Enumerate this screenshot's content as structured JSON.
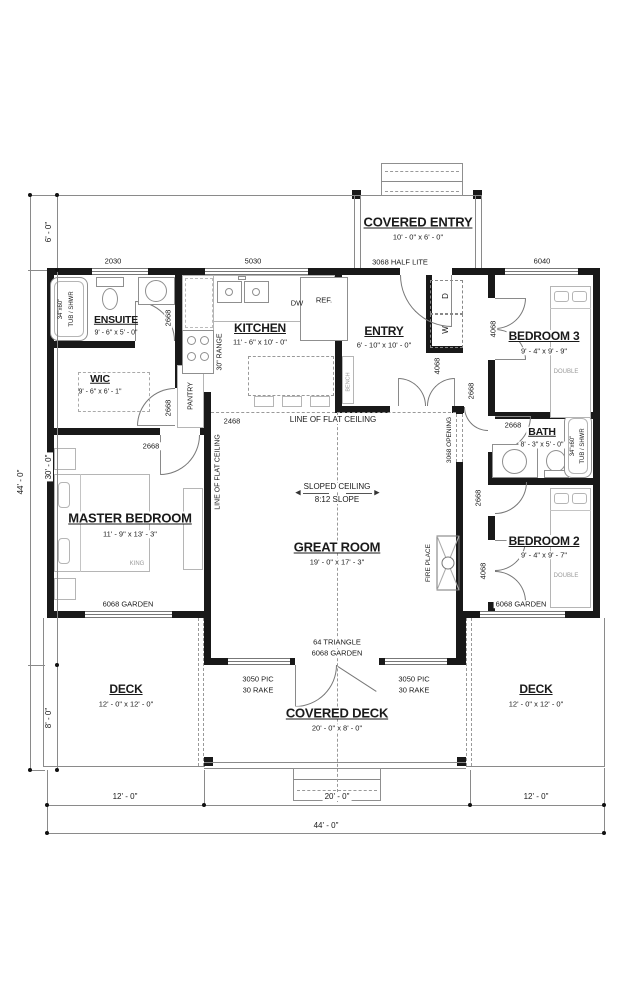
{
  "title": "Floor Plan",
  "rooms": {
    "covered_entry": {
      "name": "COVERED ENTRY",
      "dims": "10' - 0\" x 6' - 0\""
    },
    "ensuite": {
      "name": "ENSUITE",
      "dims": "9' - 6\" x 5' - 0\""
    },
    "wic": {
      "name": "WIC",
      "dims": "9' - 6\" x 6' - 1\""
    },
    "kitchen": {
      "name": "KITCHEN",
      "dims": "11' - 6\" x 10' - 0\""
    },
    "entry": {
      "name": "ENTRY",
      "dims": "6' - 10\" x 10' - 0\""
    },
    "bedroom3": {
      "name": "BEDROOM 3",
      "dims": "9' - 4\" x 9' - 9\""
    },
    "bath": {
      "name": "BATH",
      "dims": "8' - 3\" x 5' - 0\""
    },
    "master": {
      "name": "MASTER BEDROOM",
      "dims": "11' - 9\" x 13' - 3\""
    },
    "great": {
      "name": "GREAT ROOM",
      "dims": "19' - 0\" x 17' - 3\""
    },
    "bedroom2": {
      "name": "BEDROOM 2",
      "dims": "9' - 4\" x 9' - 7\""
    },
    "deck_left": {
      "name": "DECK",
      "dims": "12' - 0\" x 12' - 0\""
    },
    "covered_deck": {
      "name": "COVERED DECK",
      "dims": "20' - 0\" x 8' - 0\""
    },
    "deck_right": {
      "name": "DECK",
      "dims": "12' - 0\" x 12' - 0\""
    }
  },
  "openings": {
    "w2030": "2030",
    "w5030": "5030",
    "w6040": "6040",
    "half_lite": "3068 HALF LITE",
    "opening_3068": "3068 OPENING",
    "d2668": "2668",
    "d2468": "2468",
    "d4068": "4068",
    "garden_6068": "6068 GARDEN",
    "triangle_64": "64 TRIANGLE",
    "pic_3050": "3050 PIC",
    "rake_30": "30 RAKE"
  },
  "annotations": {
    "flat_ceiling": "LINE OF FLAT CEILING",
    "sloped_ceiling": "SLOPED CEILING",
    "slope": "8:12 SLOPE",
    "arrow_left": "◀",
    "arrow_right": "▶",
    "fireplace": "FIRE PLACE",
    "pantry": "PANTRY",
    "range": "30\" RANGE",
    "bench": "BENCH",
    "dw": "DW",
    "ref": "REF.",
    "washer": "W",
    "dryer": "D",
    "king": "KING",
    "double": "DOUBLE",
    "tub_size": "34\"x60\"",
    "tub_type": "TUB / SHWR"
  },
  "dimensions": {
    "total_v": "44' - 0\"",
    "top_v": "6' - 0\"",
    "mid_v": "30' - 0\"",
    "bottom_v": "8' - 0\"",
    "total_h": "44' - 0\"",
    "left_h": "12' - 0\"",
    "center_h": "20' - 0\"",
    "right_h": "12' - 0\""
  },
  "colors": {
    "wall": "#191919",
    "line": "#8a8a8a",
    "text": "#1a1a1a"
  }
}
